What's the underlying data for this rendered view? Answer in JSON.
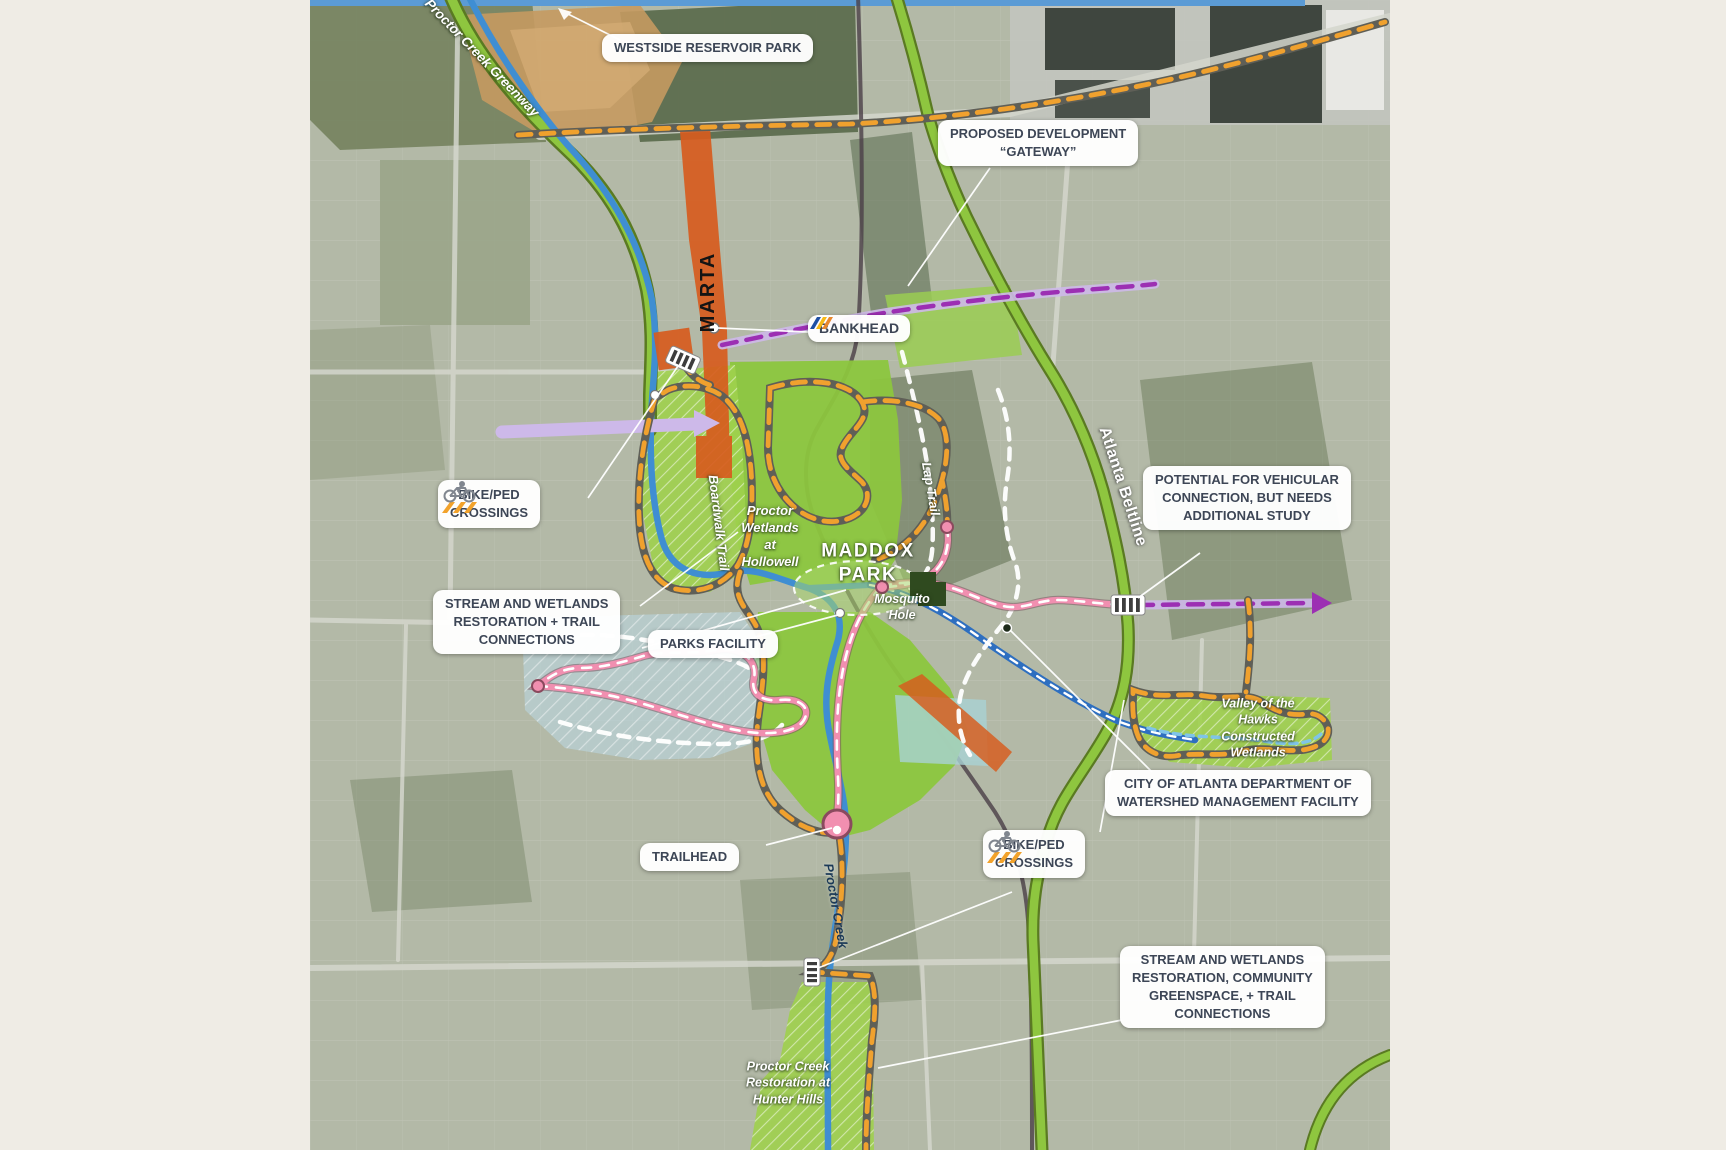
{
  "canvas": {
    "bg": "#efece5",
    "map_bg": "#b3b9a7"
  },
  "colors": {
    "callout_text": "#3d4656",
    "greenway_green": "#8ec63f",
    "creek_blue": "#3f8ed2",
    "marta_orange": "#d75c1e",
    "trail_orange": "#f0a12e",
    "trail_pink": "#f18fb0",
    "proposed_purple": "#9c2fb3",
    "lavender": "#cdb9e9",
    "park_green": "#8cc63e",
    "wetland_hatch": "#9ed04e",
    "blue_overlay": "#b9d6df",
    "crosswalk_gold": "#f2a22b"
  },
  "icons": {
    "bike_ped": "bike-crossing-icon",
    "bankhead": "marta-logo-icon",
    "crosswalk": "crosswalk-icon",
    "trailhead_node": "trailhead-circle-icon"
  },
  "callouts": {
    "westside": {
      "lines": [
        "WESTSIDE RESERVOIR PARK"
      ]
    },
    "proposed_dev": {
      "lines": [
        "PROPOSED DEVELOPMENT",
        "“GATEWAY”"
      ]
    },
    "bankhead": {
      "label": "BANKHEAD"
    },
    "bike_ped_left": {
      "lines": [
        "BIKE/PED",
        "CROSSINGS"
      ]
    },
    "potential": {
      "lines": [
        "POTENTIAL FOR VEHICULAR",
        "CONNECTION, BUT NEEDS",
        "ADDITIONAL STUDY"
      ]
    },
    "stream_left": {
      "lines": [
        "STREAM AND WETLANDS",
        "RESTORATION + TRAIL",
        "CONNECTIONS"
      ]
    },
    "parks_facility": {
      "lines": [
        "PARKS FACILITY"
      ]
    },
    "watershed": {
      "lines": [
        "CITY OF ATLANTA DEPARTMENT OF",
        "WATERSHED MANAGEMENT FACILITY"
      ]
    },
    "trailhead": {
      "lines": [
        "TRAILHEAD"
      ]
    },
    "bike_ped_right": {
      "lines": [
        "BIKE/PED",
        "CROSSINGS"
      ]
    },
    "stream_right": {
      "lines": [
        "STREAM AND WETLANDS",
        "RESTORATION, COMMUNITY",
        "GREENSPACE, + TRAIL",
        "CONNECTIONS"
      ]
    }
  },
  "map_labels": {
    "greenway": "Proctor Creek Greenway",
    "marta": "MARTA",
    "beltline": "Atlanta Beltline",
    "boardwalk": "Boardwalk Trail",
    "hollowell": {
      "lines": [
        "Proctor",
        "Wetlands",
        "at",
        "Hollowell"
      ]
    },
    "maddox": {
      "lines": [
        "MADDOX",
        "PARK"
      ]
    },
    "lap": "Lap Trail",
    "mosquito": {
      "lines": [
        "Mosquito",
        "Hole"
      ]
    },
    "valley": {
      "lines": [
        "Valley of the",
        "Hawks",
        "Constructed",
        "Wetlands"
      ]
    },
    "proctor_creek": "Proctor Creek",
    "hunter": {
      "lines": [
        "Proctor Creek",
        "Restoration at",
        "Hunter Hills"
      ]
    }
  }
}
